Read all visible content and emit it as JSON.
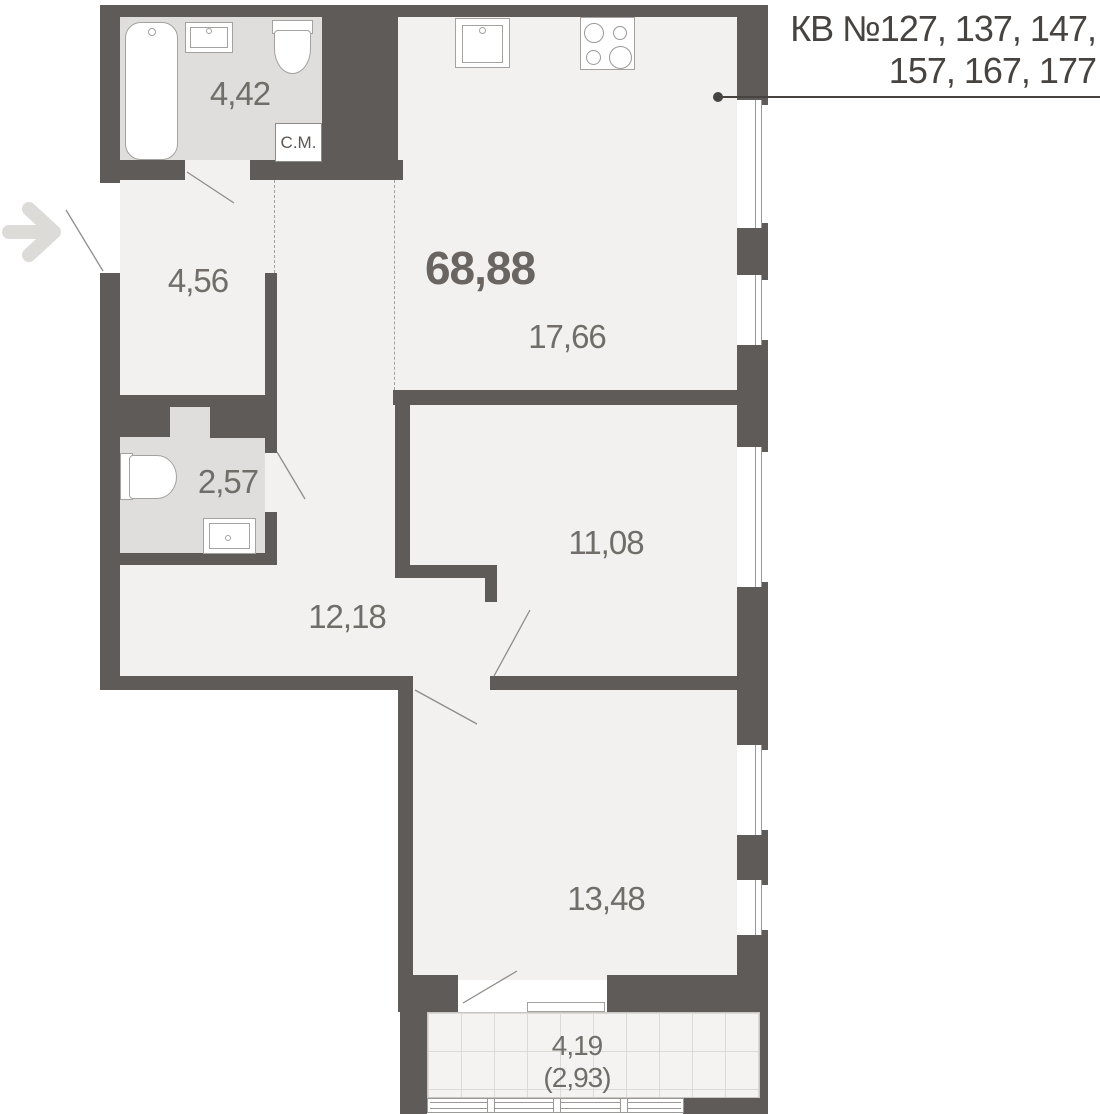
{
  "title": {
    "line1": "КВ №127, 137, 147,",
    "line2": "157, 167, 177"
  },
  "total_area": "68,88",
  "rooms": {
    "bathroom": {
      "area": "4,42"
    },
    "hallway": {
      "area": "4,56"
    },
    "kitchen_living": {
      "area": "17,66"
    },
    "wc": {
      "area": "2,57"
    },
    "corridor": {
      "area": "12,18"
    },
    "room_11": {
      "area": "11,08"
    },
    "room_13": {
      "area": "13,48"
    },
    "balcony": {
      "area": "4,19",
      "area_coefficient": "(2,93)"
    }
  },
  "labels": {
    "washing_machine": "С.М."
  },
  "icons": {
    "entrance_arrow": "entrance-arrow-icon"
  },
  "colors": {
    "wall": "#5f5b58",
    "floor_main": "#f2f1ef",
    "floor_wet": "#e0dedc",
    "balcony_floor": "#f4f3f1",
    "title_text": "#474340",
    "label_text": "#716d69"
  }
}
